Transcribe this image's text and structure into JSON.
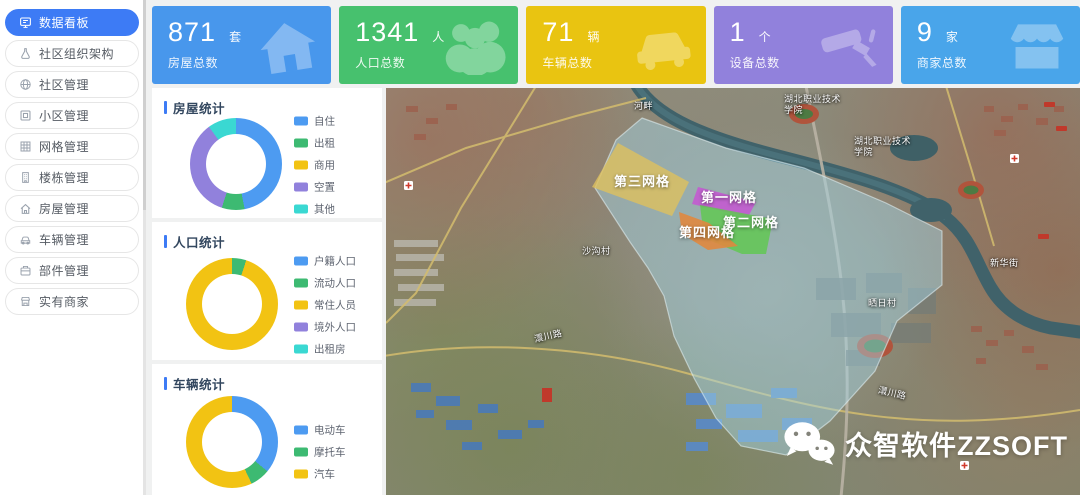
{
  "sidebar": {
    "active_color": "#3d7bf5",
    "items": [
      {
        "label": "数据看板",
        "icon": "dashboard-icon",
        "active": true
      },
      {
        "label": "社区组织架构",
        "icon": "org-icon"
      },
      {
        "label": "社区管理",
        "icon": "community-icon"
      },
      {
        "label": "小区管理",
        "icon": "residential-icon"
      },
      {
        "label": "网格管理",
        "icon": "grid-icon"
      },
      {
        "label": "楼栋管理",
        "icon": "building-icon"
      },
      {
        "label": "房屋管理",
        "icon": "house-icon"
      },
      {
        "label": "车辆管理",
        "icon": "vehicle-icon"
      },
      {
        "label": "部件管理",
        "icon": "component-icon"
      },
      {
        "label": "实有商家",
        "icon": "merchant-icon"
      }
    ]
  },
  "stats": [
    {
      "value": "871",
      "unit": "套",
      "label": "房屋总数",
      "color": "#4897ec",
      "icon": "house-icon"
    },
    {
      "value": "1341",
      "unit": "人",
      "label": "人口总数",
      "color": "#47c16e",
      "icon": "people-icon"
    },
    {
      "value": "71",
      "unit": "辆",
      "label": "车辆总数",
      "color": "#e9c411",
      "icon": "car-icon"
    },
    {
      "value": "1",
      "unit": "个",
      "label": "设备总数",
      "color": "#9181dc",
      "icon": "camera-icon"
    },
    {
      "value": "9",
      "unit": "家",
      "label": "商家总数",
      "color": "#49a5ea",
      "icon": "shop-icon"
    }
  ],
  "chart_data": [
    {
      "type": "pie",
      "title": "房屋统计",
      "labels": [
        "自住",
        "出租",
        "商用",
        "空置",
        "其他"
      ],
      "values": [
        47,
        8,
        0,
        35,
        10
      ],
      "unit": "percent",
      "colors": [
        "#4d9bf1",
        "#3dba72",
        "#f2c313",
        "#9181dc",
        "#3ad8d2"
      ],
      "legend_position": "right",
      "shape": "donut"
    },
    {
      "type": "pie",
      "title": "人口统计",
      "labels": [
        "户籍人口",
        "流动人口",
        "常住人员",
        "境外人口",
        "出租房"
      ],
      "values": [
        0,
        5,
        95,
        0,
        0
      ],
      "unit": "percent",
      "colors": [
        "#4d9bf1",
        "#3dba72",
        "#f2c313",
        "#9181dc",
        "#3ad8d2"
      ],
      "legend_position": "right",
      "shape": "donut"
    },
    {
      "type": "pie",
      "title": "车辆统计",
      "labels": [
        "电动车",
        "摩托车",
        "汽车"
      ],
      "values": [
        36,
        7,
        57
      ],
      "unit": "percent",
      "colors": [
        "#4d9bf1",
        "#3dba72",
        "#f2c313"
      ],
      "legend_position": "right",
      "shape": "donut"
    }
  ],
  "map": {
    "overlay_color": "#a5d8e8",
    "zones": [
      {
        "label": "第三网格",
        "color": "#dfc05e"
      },
      {
        "label": "第一网格",
        "color": "#c556d2"
      },
      {
        "label": "第二网格",
        "color": "#5ec94e"
      },
      {
        "label": "第四网格",
        "color": "#e0883f"
      }
    ],
    "labels": [
      "湖北职业技术学院",
      "湖北职业技术学院",
      "河畔",
      "沙沟村",
      "澴川路",
      "澴川路",
      "晒日村",
      "新华街"
    ],
    "watermark": "众智软件ZZSOFT"
  }
}
